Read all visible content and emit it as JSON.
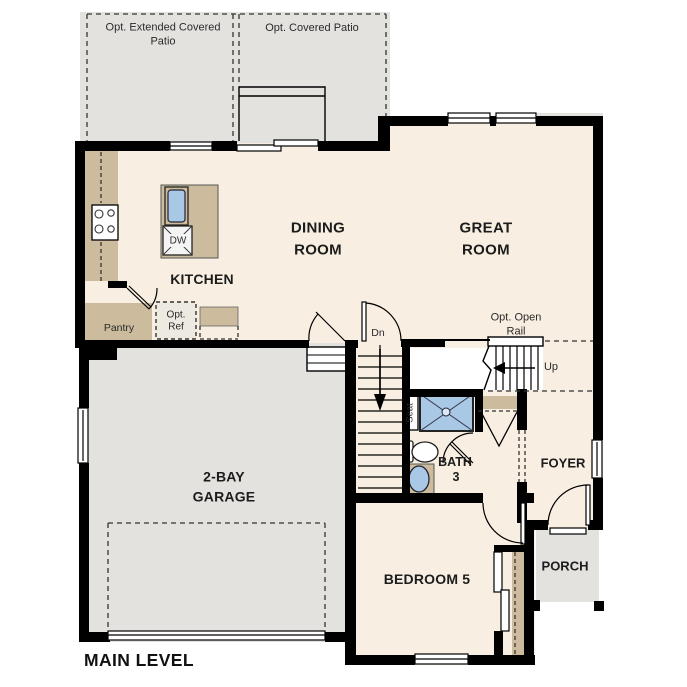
{
  "plan_title": "MAIN LEVEL",
  "rooms": {
    "dining_room": "DINING\nROOM",
    "great_room": "GREAT\nROOM",
    "kitchen": "KITCHEN",
    "garage": "2-BAY\nGARAGE",
    "bedroom_5": "BEDROOM 5",
    "bath": "BATH",
    "bath_number": "3",
    "foyer": "FOYER",
    "porch": "PORCH"
  },
  "options": {
    "extended_covered_patio": "Opt. Extended Covered\nPatio",
    "covered_patio": "Opt. Covered Patio",
    "open_rail": "Opt. Open\nRail",
    "optional_refrigerator": "Opt.\nRef"
  },
  "labels": {
    "stairs_down": "Dn",
    "stairs_up": "Up",
    "shower_seat": "Seat",
    "dishwasher": "DW",
    "pantry": "Pantry"
  },
  "colors": {
    "wall": "#000000",
    "interior_floor": "#f8efe2",
    "exterior_floor": "#e3e2df",
    "counter": "#ccbb9d",
    "fixture_blue": "#a9c8e6",
    "dash": "#333333",
    "text": "#1c1c1c"
  }
}
